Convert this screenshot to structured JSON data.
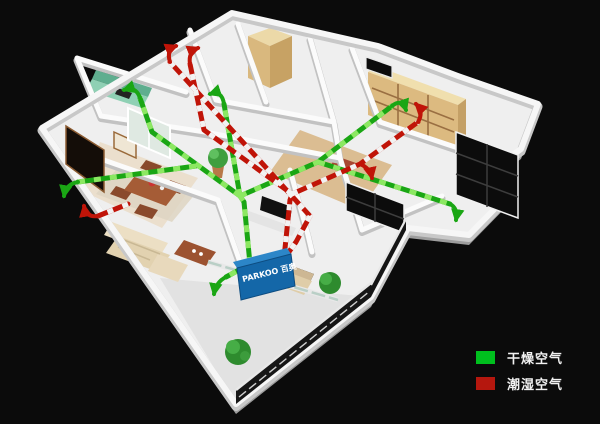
{
  "scene": {
    "background_color": "#0b0b0b",
    "render_name": "apartment-ventilation-3d-cutaway"
  },
  "unit": {
    "brand_label": "PARKOO 百奥",
    "box_color": "#1467a8"
  },
  "legend": {
    "items": [
      {
        "label": "干燥空气",
        "color": "#00bf1e"
      },
      {
        "label": "潮湿空气",
        "color": "#b5170e"
      }
    ]
  },
  "airflow": {
    "dry_air_color": "#1aa614",
    "dry_air_dash_color": "#8ce862",
    "humid_air_color": "#c01408",
    "humid_air_dash_color": "#f2f2f2"
  }
}
